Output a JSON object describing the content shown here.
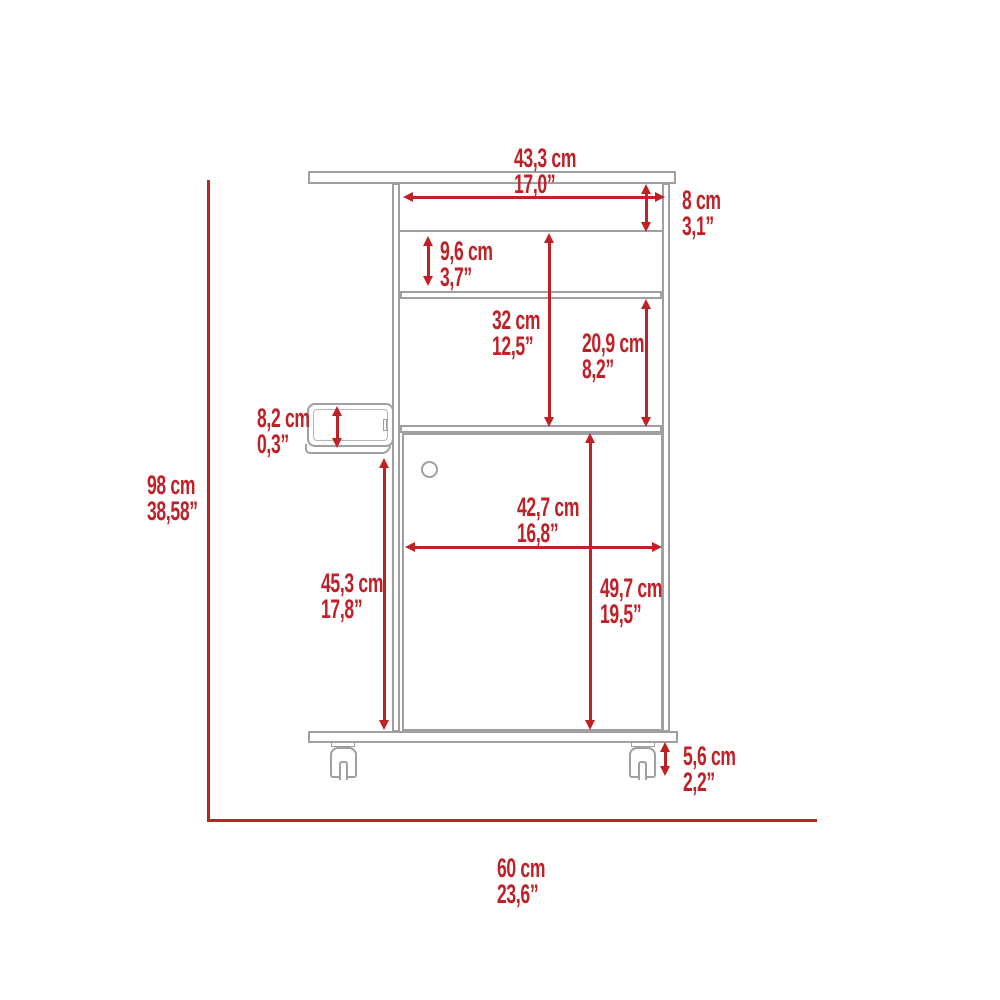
{
  "diagram": {
    "title": "bar-cart-dimension-drawing",
    "view": "front elevation with casters and side bottle opener"
  },
  "colors": {
    "red": "#bf2127",
    "gray": "#a0a0a0",
    "bg": "#ffffff"
  },
  "dimensions": {
    "top_width": {
      "cm": "43,3 cm",
      "inch": "17,0”"
    },
    "top_shelf_height": {
      "cm": "8 cm",
      "inch": "3,1”"
    },
    "second_shelf_height": {
      "cm": "9,6 cm",
      "inch": "3,7”"
    },
    "open_section_height": {
      "cm": "32 cm",
      "inch": "12,5”"
    },
    "upper_compartment_height": {
      "cm": "20,9 cm",
      "inch": "8,2”"
    },
    "side_holder_height": {
      "cm": "8,2 cm",
      "inch": "0,3”"
    },
    "overall_height": {
      "cm": "98 cm",
      "inch": "38,58”"
    },
    "door_width": {
      "cm": "42,7 cm",
      "inch": "16,8”"
    },
    "lower_left_height": {
      "cm": "45,3 cm",
      "inch": "17,8”"
    },
    "door_height": {
      "cm": "49,7 cm",
      "inch": "19,5”"
    },
    "caster_height": {
      "cm": "5,6 cm",
      "inch": "2,2”"
    },
    "overall_width": {
      "cm": "60 cm",
      "inch": "23,6”"
    }
  }
}
